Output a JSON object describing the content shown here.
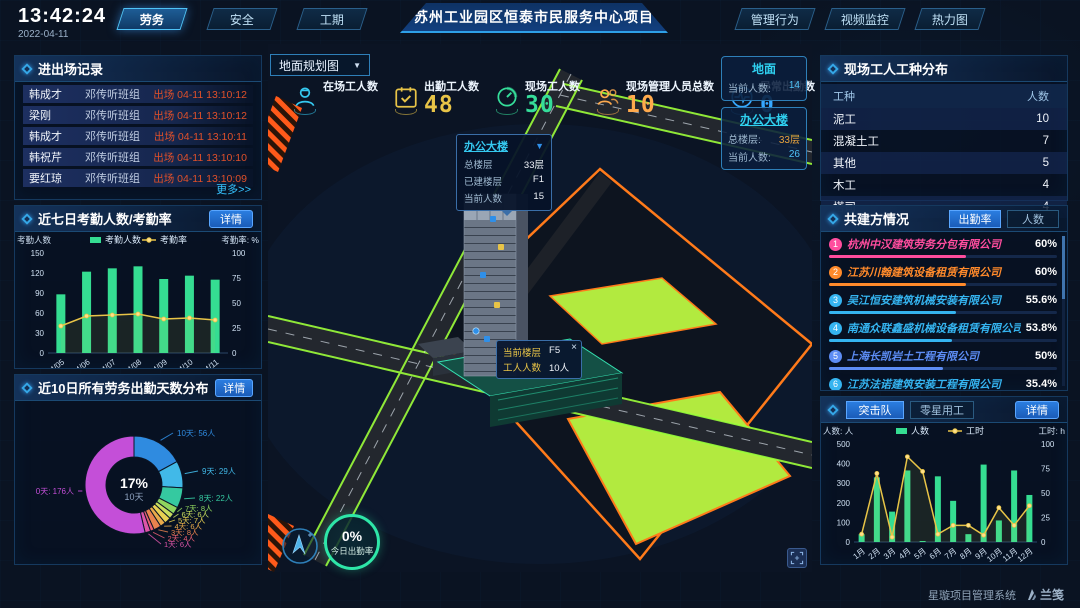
{
  "header": {
    "time": "13:42:24",
    "date": "2022-04-11",
    "nav_left": [
      {
        "label": "劳务",
        "active": true
      },
      {
        "label": "安全",
        "active": false
      },
      {
        "label": "工期",
        "active": false
      }
    ],
    "title": "苏州工业园区恒泰市民服务中心项目",
    "nav_right": [
      {
        "label": "管理行为",
        "active": false
      },
      {
        "label": "视频监控",
        "active": false
      },
      {
        "label": "热力图",
        "active": false
      }
    ]
  },
  "entry_exit_panel": {
    "title": "进出场记录",
    "more_label": "更多>>",
    "records": [
      {
        "name": "韩成才",
        "team": "邓传听班组",
        "event": "出场 04-11 13:10:12"
      },
      {
        "name": "梁刚",
        "team": "邓传听班组",
        "event": "出场 04-11 13:10:12"
      },
      {
        "name": "韩成才",
        "team": "邓传听班组",
        "event": "出场 04-11 13:10:11"
      },
      {
        "name": "韩祝芹",
        "team": "邓传听班组",
        "event": "出场 04-11 13:10:10"
      },
      {
        "name": "要红琼",
        "team": "邓传听班组",
        "event": "出场 04-11 13:10:09"
      }
    ]
  },
  "attendance_panel": {
    "title": "近七日考勤人数/考勤率",
    "detail_label": "详情"
  },
  "distribution_panel": {
    "title": "近10日所有劳务出勤天数分布",
    "detail_label": "详情"
  },
  "worker_types_panel": {
    "title": "现场工人工种分布",
    "columns": [
      "工种",
      "人数"
    ],
    "rows": [
      {
        "type": "泥工",
        "count": "10"
      },
      {
        "type": "混凝土工",
        "count": "7"
      },
      {
        "type": "其他",
        "count": "5"
      },
      {
        "type": "木工",
        "count": "4"
      },
      {
        "type": "塔司",
        "count": "4"
      }
    ]
  },
  "partners_panel": {
    "title": "共建方情况",
    "tabs": [
      "出勤率",
      "人数"
    ],
    "companies": [
      {
        "rank": "1",
        "name": "杭州中汉建筑劳务分包有限公司",
        "percent": "60%",
        "value": 60,
        "color": "#ff4d9e"
      },
      {
        "rank": "2",
        "name": "江苏川翰建筑设备租赁有限公司",
        "percent": "60%",
        "value": 60,
        "color": "#ff8a2b"
      },
      {
        "rank": "3",
        "name": "吴江恒安建筑机械安装有限公司",
        "percent": "55.6%",
        "value": 55.6,
        "color": "#35b4f0"
      },
      {
        "rank": "4",
        "name": "南通众联鑫盛机械设备租赁有限公司",
        "percent": "53.8%",
        "value": 53.8,
        "color": "#35b4f0"
      },
      {
        "rank": "5",
        "name": "上海长凯岩土工程有限公司",
        "percent": "50%",
        "value": 50,
        "color": "#5d8df5"
      },
      {
        "rank": "6",
        "name": "江苏法诺建筑安装工程有限公司",
        "percent": "35.4%",
        "value": 35.4,
        "color": "#35b4f0"
      }
    ]
  },
  "team_panel": {
    "tabs": [
      "突击队",
      "零星用工"
    ],
    "detail_label": "详情"
  },
  "map": {
    "layer_dropdown": "地面规划图",
    "stats": [
      {
        "label": "在场工人数",
        "value": "",
        "icon": "worker-icon",
        "color": "#35c9f0"
      },
      {
        "label": "出勤工人数",
        "value": "48",
        "icon": "calendar-check-icon",
        "color": "#e8c447"
      },
      {
        "label": "现场工人数",
        "value": "30",
        "icon": "gauge-icon",
        "color": "#35dd9a"
      },
      {
        "label": "现场管理人员总数",
        "value": "10",
        "icon": "people-icon",
        "color": "#ffaa4d"
      },
      {
        "label": "异常出勤数",
        "value": "0",
        "icon": "pulse-icon",
        "color": "#35a8ff"
      }
    ],
    "popups": [
      {
        "title": "地面",
        "underline": false,
        "rows": [
          {
            "label": "当前人数:",
            "value": "14",
            "color": "#4fc3f7"
          }
        ]
      },
      {
        "title": "办公大楼",
        "underline": true,
        "rows": [
          {
            "label": "总楼层:",
            "value": "33层",
            "color": "#e8a33d"
          },
          {
            "label": "当前人数:",
            "value": "26",
            "color": "#4fc3f7"
          }
        ]
      }
    ],
    "building_tooltip": {
      "title": "办公大楼",
      "rows": [
        {
          "label": "总楼层",
          "value": "33层"
        },
        {
          "label": "已建楼层",
          "value": "F1"
        },
        {
          "label": "当前人数",
          "value": "15"
        }
      ]
    },
    "floor_tooltip": {
      "close_label": "×",
      "rows": [
        {
          "label": "当前楼层",
          "value": "F5"
        },
        {
          "label": "工人人数",
          "value": "10人"
        }
      ]
    },
    "gauge": {
      "value": "0%",
      "label": "今日出勤率"
    }
  },
  "footer": {
    "system_name": "星璇项目管理系统",
    "logo_text": "兰笺"
  },
  "chart_data": [
    {
      "id": "attendance",
      "type": "bar",
      "title": "近七日考勤人数/考勤率",
      "categories": [
        "04/05",
        "04/06",
        "04/07",
        "04/08",
        "04/09",
        "04/10",
        "04/11"
      ],
      "series": [
        {
          "name": "考勤人数",
          "type": "bar",
          "color": "#35dd92",
          "values": [
            88,
            122,
            127,
            130,
            111,
            116,
            110
          ]
        },
        {
          "name": "考勤率",
          "type": "line",
          "color": "#e8c447",
          "axis": "right",
          "values": [
            27,
            37,
            38,
            39,
            34,
            35,
            33
          ]
        }
      ],
      "ylabel_left": "考勤人数",
      "ylabel_right": "考勤率: %",
      "ylim_left": [
        0,
        150
      ],
      "ylim_right": [
        0,
        100
      ],
      "left_ticks": [
        0,
        30,
        60,
        90,
        120,
        150
      ],
      "right_ticks": [
        0,
        25,
        50,
        75,
        100
      ],
      "legend_position": "top",
      "grid": false
    },
    {
      "id": "attendance-days-distribution",
      "type": "pie",
      "title": "近10日所有劳务出勤天数分布",
      "labels": [
        "10天",
        "9天",
        "8天",
        "7天",
        "6天",
        "5天",
        "4天",
        "3天",
        "2天",
        "1天",
        "0天"
      ],
      "values": [
        56,
        29,
        22,
        8,
        6,
        7,
        6,
        8,
        4,
        6,
        176
      ],
      "unit": "人",
      "colors": [
        "#2f8be0",
        "#41b9e8",
        "#35c9a0",
        "#8fd45e",
        "#c8dd5e",
        "#e8d052",
        "#e8aa4a",
        "#e8834e",
        "#e85f72",
        "#dd55a8",
        "#c44fd8"
      ],
      "center_value": "17%",
      "center_label": "10天"
    },
    {
      "id": "assault-team-monthly",
      "type": "bar",
      "title": "突击队",
      "categories": [
        "1月",
        "2月",
        "3月",
        "4月",
        "5月",
        "6月",
        "7月",
        "8月",
        "9月",
        "10月",
        "11月",
        "12月"
      ],
      "series": [
        {
          "name": "人数",
          "type": "bar",
          "color": "#35dd92",
          "values": [
            40,
            330,
            155,
            365,
            5,
            335,
            210,
            40,
            395,
            110,
            365,
            240
          ]
        },
        {
          "name": "工时",
          "type": "line",
          "color": "#e8c447",
          "axis": "right",
          "values": [
            8,
            70,
            5,
            87,
            72,
            8,
            17,
            17,
            7,
            35,
            17,
            37
          ]
        }
      ],
      "ylabel_left": "人数: 人",
      "ylabel_right": "工时: h",
      "ylim_left": [
        0,
        500
      ],
      "ylim_right": [
        0,
        100
      ],
      "left_ticks": [
        0,
        100,
        200,
        300,
        400,
        500
      ],
      "right_ticks": [
        0,
        25,
        50,
        75,
        100
      ],
      "legend_position": "top",
      "grid": false
    }
  ]
}
